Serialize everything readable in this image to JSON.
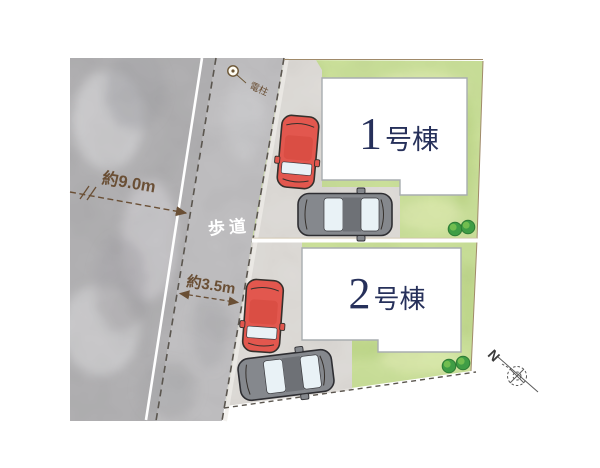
{
  "labels": {
    "road_width": "約9.0m",
    "sidewalk": "歩道",
    "sidewalk_width": "約3.5m",
    "utility_pole": "電柱",
    "north": "N"
  },
  "buildings": [
    {
      "number": "1",
      "suffix": "号棟"
    },
    {
      "number": "2",
      "suffix": "号棟"
    }
  ],
  "icons": [
    "utility-pole-icon",
    "red-car-icon",
    "gray-car-icon",
    "tree-icon",
    "north-compass-icon"
  ],
  "colors": {
    "bg": "#ffffff",
    "road": "#b4b3b5",
    "sidewalk": "#c3c2c4",
    "concrete": "#e2dfdb",
    "grass": "#cee49c",
    "building": "#ffffff",
    "building-border": "#a9adb0",
    "lot-border": "#a08a6a",
    "ink-navy": "#26305a",
    "annotation": "#6a4f35",
    "dash": "#5b564f",
    "white-line": "#ffffff",
    "car-red": "#e2574e",
    "car-gray": "#85888d",
    "car-window": "#e9f2f6",
    "tree": "#3f9d45",
    "tree-dark": "#2c7a33",
    "tree-light": "#7ac351",
    "compass": "#5a5a5a"
  }
}
